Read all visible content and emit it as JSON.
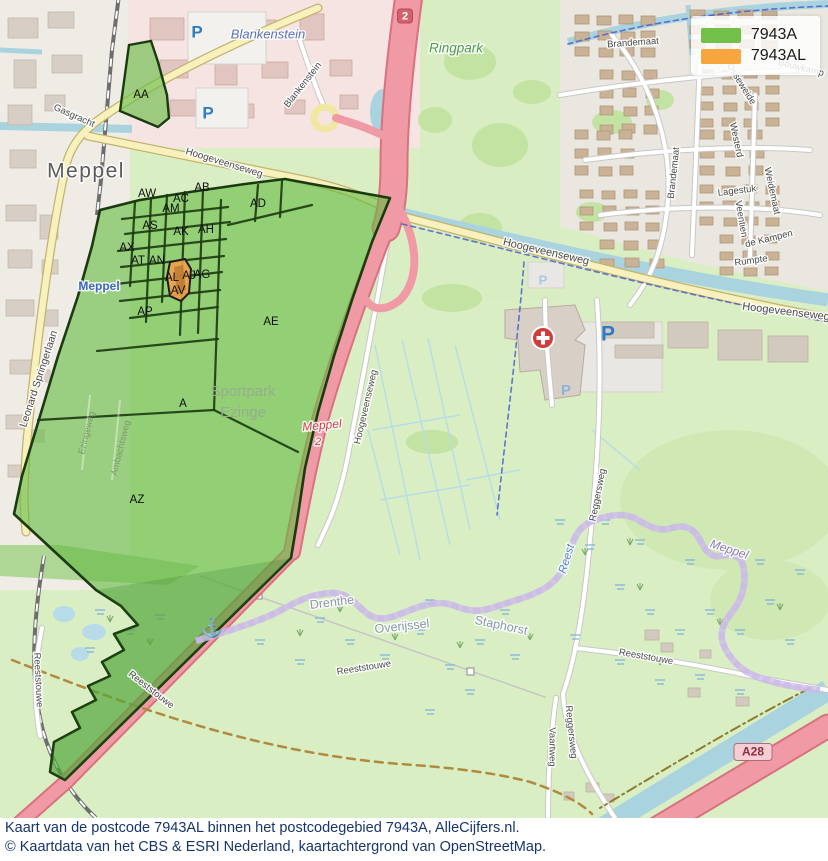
{
  "legend": {
    "items": [
      {
        "name": "legend-item-7943a",
        "label": "7943A",
        "color": "#72bf4a"
      },
      {
        "name": "legend-item-7943al",
        "label": "7943AL",
        "color": "#f7a63d"
      }
    ]
  },
  "caption": {
    "line1": "Kaart van de postcode 7943AL binnen het postcodegebied 7943A, AlleCijfers.nl.",
    "line2": "© Kaartdata van het CBS & ESRI Nederland, kaartachtergrond van OpenStreetMap."
  },
  "map": {
    "colors": {
      "postcode_area_green": "#72bf4a",
      "postcode_area_orange": "#f7a63d",
      "area_border": "#1c3a10",
      "motorway_pink": "#ef9aa4",
      "water_blue": "#a9d3df",
      "province_boundary_purple": "#8a6cc0"
    },
    "area_labels": [
      {
        "name": "area-label-aa",
        "text": "AA",
        "x": 141,
        "y": 95
      },
      {
        "name": "area-label-aw",
        "text": "AW",
        "x": 147,
        "y": 194
      },
      {
        "name": "area-label-ab",
        "text": "AB",
        "x": 202,
        "y": 188
      },
      {
        "name": "area-label-ac",
        "text": "AC",
        "x": 181,
        "y": 199
      },
      {
        "name": "area-label-am",
        "text": "AM",
        "x": 171,
        "y": 209
      },
      {
        "name": "area-label-ad",
        "text": "AD",
        "x": 258,
        "y": 204
      },
      {
        "name": "area-label-as",
        "text": "AS",
        "x": 150,
        "y": 226
      },
      {
        "name": "area-label-ak",
        "text": "AK",
        "x": 181,
        "y": 232
      },
      {
        "name": "area-label-ah",
        "text": "AH",
        "x": 206,
        "y": 230
      },
      {
        "name": "area-label-ax",
        "text": "AX",
        "x": 127,
        "y": 248
      },
      {
        "name": "area-label-at",
        "text": "AT",
        "x": 138,
        "y": 261
      },
      {
        "name": "area-label-an",
        "text": "AN",
        "x": 157,
        "y": 261
      },
      {
        "name": "area-label-al",
        "text": "AL",
        "x": 172,
        "y": 278
      },
      {
        "name": "area-label-aj",
        "text": "AJ",
        "x": 189,
        "y": 276
      },
      {
        "name": "area-label-ag",
        "text": "AG",
        "x": 202,
        "y": 275
      },
      {
        "name": "area-label-av",
        "text": "AV",
        "x": 178,
        "y": 291
      },
      {
        "name": "area-label-ap",
        "text": "AP",
        "x": 145,
        "y": 312
      },
      {
        "name": "area-label-ae",
        "text": "AE",
        "x": 271,
        "y": 322
      },
      {
        "name": "area-label-a",
        "text": "A",
        "x": 183,
        "y": 404
      },
      {
        "name": "area-label-az",
        "text": "AZ",
        "x": 137,
        "y": 500
      }
    ],
    "place_labels": [
      {
        "name": "label-meppel-city",
        "text": "Meppel",
        "x": 86,
        "y": 172,
        "rot": 0,
        "size": 21,
        "color": "#5b5b5b",
        "halo": true,
        "spacing": 1.5
      },
      {
        "name": "label-blankenstein-place",
        "text": "Blankenstein",
        "x": 268,
        "y": 35,
        "rot": 0,
        "size": 13,
        "color": "#5a6fc0",
        "italic": true,
        "halo": true
      },
      {
        "name": "label-ringpark",
        "text": "Ringpark",
        "x": 456,
        "y": 49,
        "rot": 0,
        "size": 13.5,
        "color": "#4d9b4d",
        "italic": true,
        "halo": true
      },
      {
        "name": "label-meppel-station",
        "text": "Meppel",
        "x": 99,
        "y": 287,
        "rot": 0,
        "size": 12,
        "color": "#3a66c4",
        "weight": "bold",
        "halo": true
      },
      {
        "name": "label-sportpark-1",
        "text": "Sportpark",
        "x": 243,
        "y": 392,
        "rot": 0,
        "size": 15,
        "color": "#97ad8d",
        "halo": false
      },
      {
        "name": "label-sportpark-2",
        "text": "Ezinge",
        "x": 243,
        "y": 413,
        "rot": 0,
        "size": 15,
        "color": "#97ad8d",
        "halo": false
      },
      {
        "name": "label-drenthe",
        "text": "Drenthe",
        "x": 332,
        "y": 603,
        "rot": -7,
        "size": 12.5,
        "color": "#8a97ab",
        "halo": true
      },
      {
        "name": "label-overijssel",
        "text": "Overijssel",
        "x": 402,
        "y": 627,
        "rot": -6,
        "size": 12.5,
        "color": "#8a97ab",
        "halo": true
      },
      {
        "name": "label-staphorst",
        "text": "Staphorst",
        "x": 501,
        "y": 626,
        "rot": 12,
        "size": 12.5,
        "color": "#8a97ab",
        "halo": true
      },
      {
        "name": "label-reest-river",
        "text": "Reest",
        "x": 567,
        "y": 559,
        "rot": -73,
        "size": 11.5,
        "color": "#4e86c8",
        "italic": true,
        "halo": true
      },
      {
        "name": "label-meppel-river",
        "text": "Meppel",
        "x": 729,
        "y": 550,
        "rot": 18,
        "size": 12,
        "color": "#8d7bb5",
        "italic": true,
        "halo": true
      },
      {
        "name": "label-exit-meppel",
        "text": "Meppel",
        "x": 322,
        "y": 426,
        "rot": -5,
        "size": 12,
        "color": "#cc4046",
        "italic": true,
        "halo": true
      },
      {
        "name": "label-exit-2",
        "text": "2",
        "x": 318,
        "y": 442,
        "rot": 0,
        "size": 11,
        "color": "#cc4046",
        "italic": true,
        "halo": true
      }
    ],
    "road_labels": [
      {
        "name": "label-gasgracht",
        "text": "Gasgracht",
        "x": 74,
        "y": 116,
        "rot": 24,
        "size": 9.5,
        "color": "#4a4a4a",
        "halo": true
      },
      {
        "name": "label-blankenstein-street",
        "text": "Blankenstein",
        "x": 303,
        "y": 85,
        "rot": -52,
        "size": 9.5,
        "color": "#4a4a4a",
        "halo": true
      },
      {
        "name": "label-hoogeveenseweg-1",
        "text": "Hoogeveenseweg",
        "x": 224,
        "y": 163,
        "rot": 17,
        "size": 10,
        "color": "#4a4a4a",
        "halo": true
      },
      {
        "name": "label-hoogeveenseweg-2",
        "text": "Hoogeveenseweg",
        "x": 546,
        "y": 252,
        "rot": 13,
        "size": 11,
        "color": "#4a4a4a",
        "halo": true
      },
      {
        "name": "label-hoogeveenseweg-3",
        "text": "Hoogeveenseweg",
        "x": 786,
        "y": 312,
        "rot": 7,
        "size": 11,
        "color": "#4a4a4a",
        "halo": true
      },
      {
        "name": "label-hoogeveenseweg-4",
        "text": "Hoogeveenseweg",
        "x": 366,
        "y": 407,
        "rot": -77,
        "size": 9.5,
        "color": "#4a4a4a",
        "halo": true
      },
      {
        "name": "label-leonard-springerlaan",
        "text": "Leonard Springerlaan",
        "x": 39,
        "y": 379,
        "rot": -72,
        "size": 10.5,
        "color": "#4a4a4a",
        "halo": true
      },
      {
        "name": "label-brandemaat-h",
        "text": "Brandemaat",
        "x": 633,
        "y": 43,
        "rot": -4,
        "size": 9.5,
        "color": "#4a4a4a",
        "halo": true
      },
      {
        "name": "label-brandemaat-v",
        "text": "Brandemaat",
        "x": 674,
        "y": 173,
        "rot": -84,
        "size": 9.5,
        "color": "#4a4a4a",
        "halo": true
      },
      {
        "name": "label-bouwkamp",
        "text": "Bouwkamp",
        "x": 801,
        "y": 68,
        "rot": 14,
        "size": 9.5,
        "color": "#4a4a4a",
        "halo": true
      },
      {
        "name": "label-osseweide",
        "text": "Osseweide",
        "x": 741,
        "y": 84,
        "rot": 58,
        "size": 9.5,
        "color": "#4a4a4a",
        "halo": true
      },
      {
        "name": "label-westerd",
        "text": "Westerd",
        "x": 736,
        "y": 140,
        "rot": 78,
        "size": 9.5,
        "color": "#4a4a4a",
        "halo": true
      },
      {
        "name": "label-lagestuk",
        "text": "Lagestuk",
        "x": 737,
        "y": 191,
        "rot": -7,
        "size": 9.5,
        "color": "#4a4a4a",
        "halo": true
      },
      {
        "name": "label-veentien",
        "text": "Veentien",
        "x": 741,
        "y": 219,
        "rot": 80,
        "size": 9.5,
        "color": "#4a4a4a",
        "halo": true
      },
      {
        "name": "label-weidemaat",
        "text": "Weidemaat",
        "x": 772,
        "y": 191,
        "rot": 78,
        "size": 9.5,
        "color": "#4a4a4a",
        "halo": true
      },
      {
        "name": "label-de-kampen",
        "text": "de Kampen",
        "x": 769,
        "y": 239,
        "rot": -14,
        "size": 9.5,
        "color": "#4a4a4a",
        "halo": true
      },
      {
        "name": "label-rumpte",
        "text": "Rumpte",
        "x": 751,
        "y": 261,
        "rot": -8,
        "size": 9.5,
        "color": "#4a4a4a",
        "halo": true
      },
      {
        "name": "label-reggersweg-1",
        "text": "Reggersweg",
        "x": 598,
        "y": 495,
        "rot": -79,
        "size": 9.5,
        "color": "#4a4a4a",
        "halo": true
      },
      {
        "name": "label-reggersweg-2",
        "text": "Reggersweg",
        "x": 571,
        "y": 732,
        "rot": 84,
        "size": 9.5,
        "color": "#4a4a4a",
        "halo": true
      },
      {
        "name": "label-vaartweg",
        "text": "Vaartweg",
        "x": 552,
        "y": 747,
        "rot": 90,
        "size": 9.5,
        "color": "#4a4a4a",
        "halo": true
      },
      {
        "name": "label-reeststouwe-1",
        "text": "Reeststouwe",
        "x": 364,
        "y": 668,
        "rot": -9,
        "size": 9.5,
        "color": "#4a4a4a",
        "halo": true
      },
      {
        "name": "label-reeststouwe-2",
        "text": "Reeststouwe",
        "x": 646,
        "y": 657,
        "rot": 10,
        "size": 9.5,
        "color": "#4a4a4a",
        "halo": true
      },
      {
        "name": "label-reeststouwe-3",
        "text": "Reeststouwe",
        "x": 38,
        "y": 680,
        "rot": 87,
        "size": 9.5,
        "color": "#4a4a4a",
        "halo": true
      },
      {
        "name": "label-reeststouwe-4",
        "text": "Reeststouwe",
        "x": 151,
        "y": 690,
        "rot": 38,
        "size": 9.5,
        "color": "#4a4a4a",
        "halo": true
      },
      {
        "name": "label-ezingeweg",
        "text": "Ezingeweg",
        "x": 87,
        "y": 433,
        "rot": -76,
        "size": 9,
        "color": "#7d9b6e",
        "halo": false
      },
      {
        "name": "label-ambachtsweg",
        "text": "Ambachtsweg",
        "x": 121,
        "y": 448,
        "rot": -76,
        "size": 9,
        "color": "#7d9b6e",
        "halo": false
      }
    ],
    "icons": {
      "parking": [
        {
          "name": "parking-icon",
          "x": 197,
          "y": 33,
          "size": 17,
          "color": "#2e7cc3"
        },
        {
          "name": "parking-icon",
          "x": 208,
          "y": 114,
          "size": 17,
          "color": "#2e7cc3"
        },
        {
          "name": "parking-icon",
          "x": 608,
          "y": 335,
          "size": 21,
          "color": "#2e7cc3"
        },
        {
          "name": "parking-icon",
          "x": 543,
          "y": 281,
          "size": 13,
          "color": "#a5c8e4"
        },
        {
          "name": "parking-icon",
          "x": 566,
          "y": 391,
          "size": 15,
          "color": "#8cb6d9"
        }
      ],
      "hospital": {
        "name": "hospital-icon",
        "x": 543,
        "y": 338,
        "r": 11,
        "color": "#d23b3b",
        "glyph": "+"
      },
      "anchor": {
        "name": "anchor-icon",
        "x": 212,
        "y": 629,
        "size": 19,
        "color": "#7b68b5",
        "glyph": "⚓"
      }
    },
    "badges": [
      {
        "name": "road-badge-2",
        "text": "2",
        "x": 405,
        "y": 16,
        "bg": "#d2626e",
        "fg": "#ffffff",
        "border": "#b84a57",
        "w": 15,
        "h": 14,
        "size": 11
      },
      {
        "name": "road-badge-a28",
        "text": "A28",
        "x": 753,
        "y": 752,
        "bg": "#f5cdd4",
        "fg": "#8b2f3f",
        "border": "#b36a77",
        "w": 38,
        "h": 17,
        "size": 12
      }
    ]
  }
}
